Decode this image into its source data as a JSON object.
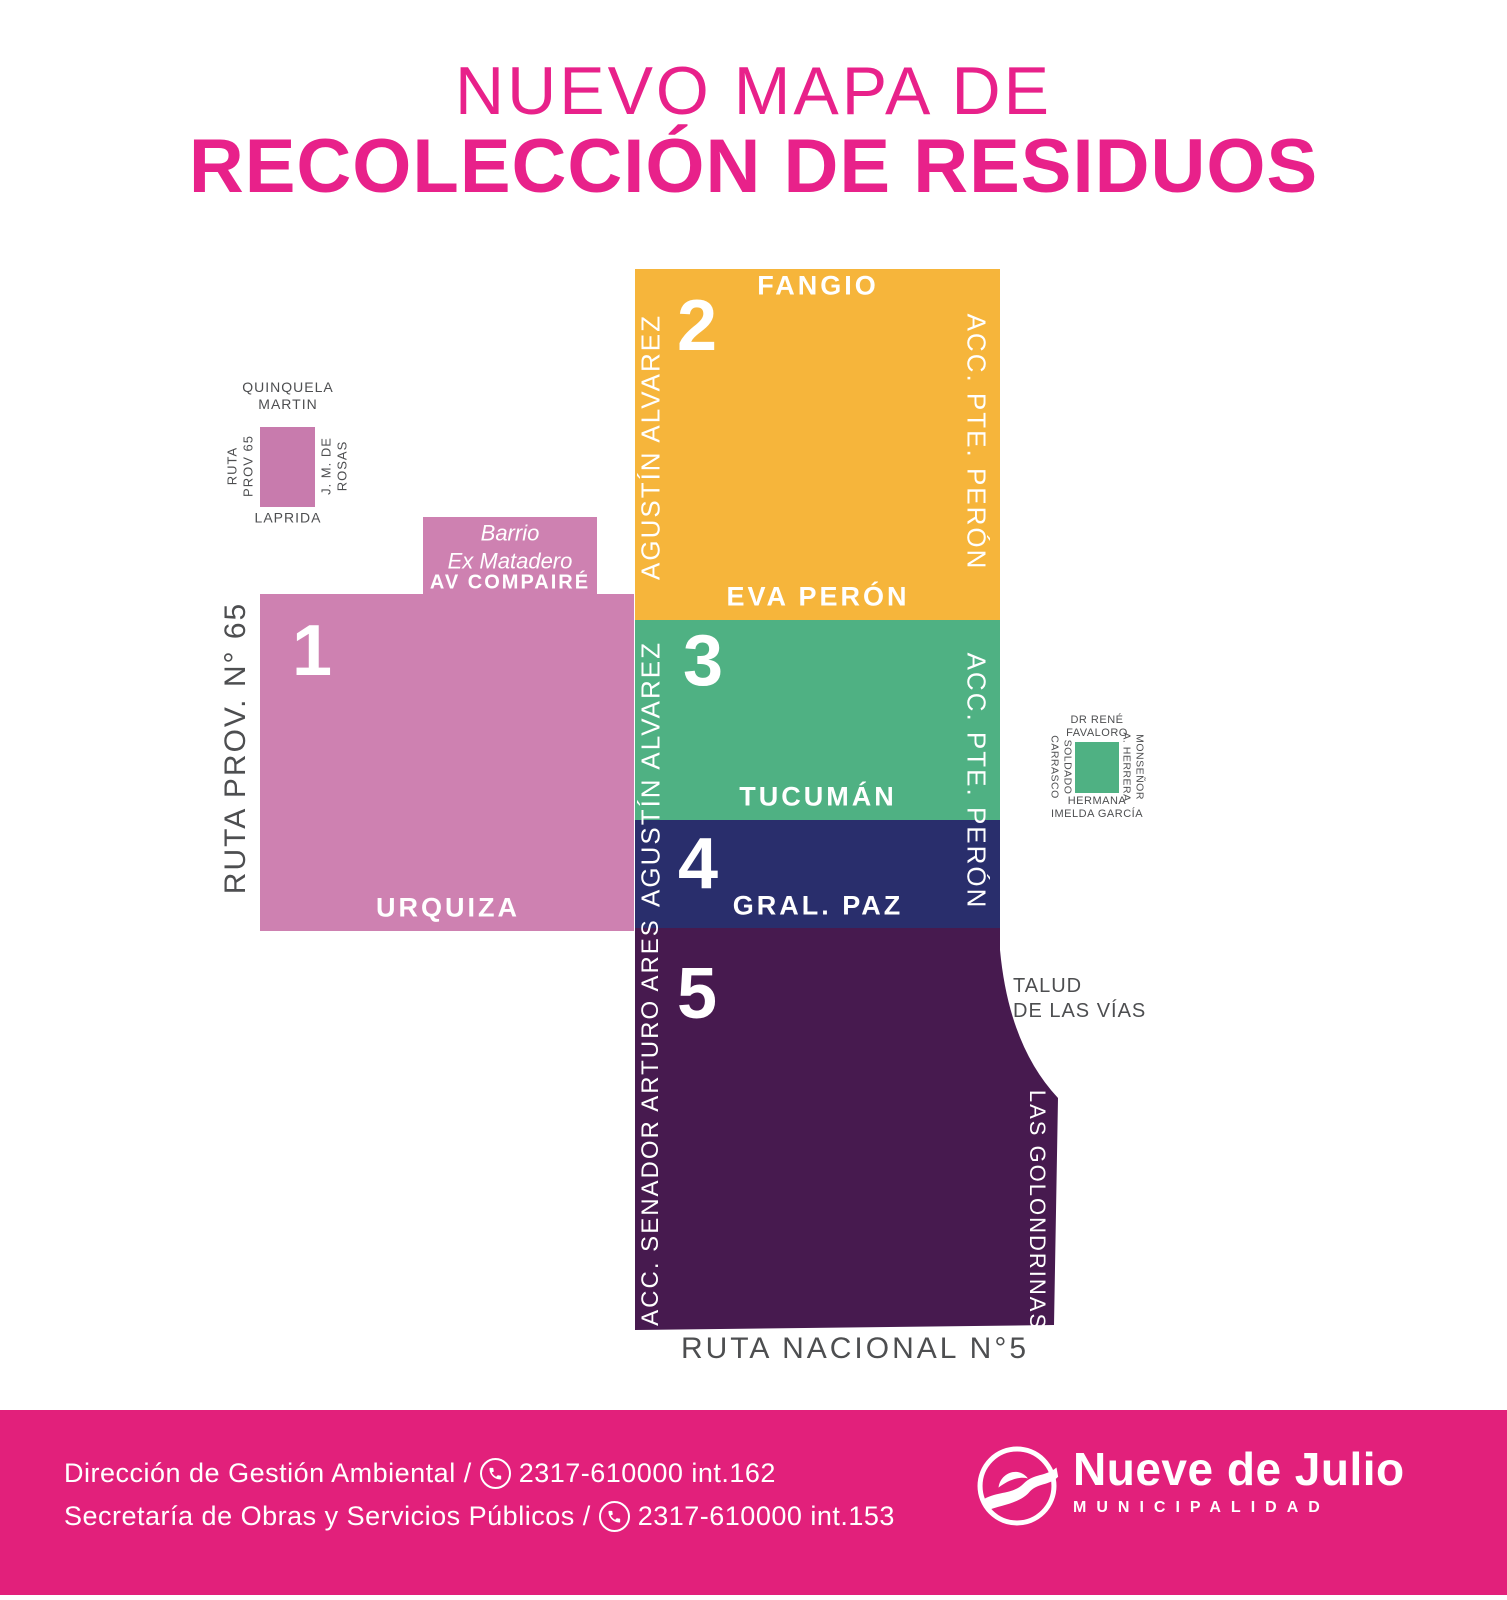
{
  "title": {
    "line1": "NUEVO MAPA DE",
    "line2": "RECOLECCIÓN DE RESIDUOS"
  },
  "map": {
    "zone1": {
      "number": "1",
      "street_urquiza": "URQUIZA",
      "barrio_line1": "Barrio",
      "barrio_line2": "Ex Matadero",
      "street_av_compaire": "AV COMPAIRÉ",
      "road_left": "RUTA PROV. N° 65"
    },
    "zone2": {
      "number": "2",
      "street_fangio": "FANGIO",
      "street_eva_peron": "EVA PERÓN",
      "road_left": "AGUSTÍN ALVAREZ",
      "road_right": "ACC. PTE. PERÓN"
    },
    "zone3": {
      "number": "3",
      "street_tucuman": "TUCUMÁN",
      "road_left": "AGUSTÍN ALVAREZ",
      "road_right": "ACC. PTE. PERÓN"
    },
    "zone4": {
      "number": "4",
      "street_gral_paz": "GRAL. PAZ"
    },
    "zone5": {
      "number": "5",
      "road_left": "ACC. SENADOR ARTURO ARES",
      "road_right": "LAS GOLONDRINAS",
      "talud_line1": "TALUD",
      "talud_line2": "DE LAS VÍAS",
      "road_bottom": "RUTA NACIONAL N°5"
    }
  },
  "legend_pink": {
    "top_line1": "QUINQUELA",
    "top_line2": "MARTIN",
    "left_line1": "RUTA",
    "left_line2": "PROV 65",
    "right_line1": "J. M. DE",
    "right_line2": "ROSAS",
    "bottom": "LAPRIDA"
  },
  "legend_green": {
    "top_line1": "DR RENÉ",
    "top_line2": "FAVALORO",
    "left_line1": "SOLDADO",
    "left_line2": "CARRASCO",
    "right_line1": "MONSEÑOR",
    "right_line2": "A. HERRERA",
    "bottom_line1": "HERMANA",
    "bottom_line2": "IMELDA GARCÍA"
  },
  "footer": {
    "line1_text": "Dirección de Gestión Ambiental /",
    "line1_phone": "2317-610000 int.162",
    "line2_text": "Secretaría de Obras y Servicios Públicos /",
    "line2_phone": "2317-610000 int.153",
    "logo_name": "Nueve de Julio",
    "logo_subtitle": "MUNICIPALIDAD"
  },
  "colors": {
    "brand_magenta": "#E8218A",
    "footer_magenta": "#E2207B",
    "zone1_pink": "#CE81B1",
    "zone2_yellow": "#F6B53B",
    "zone3_green": "#4FB183",
    "zone4_navy": "#292E6C",
    "zone5_purple": "#471A4F",
    "label_dark": "#4D4E50"
  }
}
